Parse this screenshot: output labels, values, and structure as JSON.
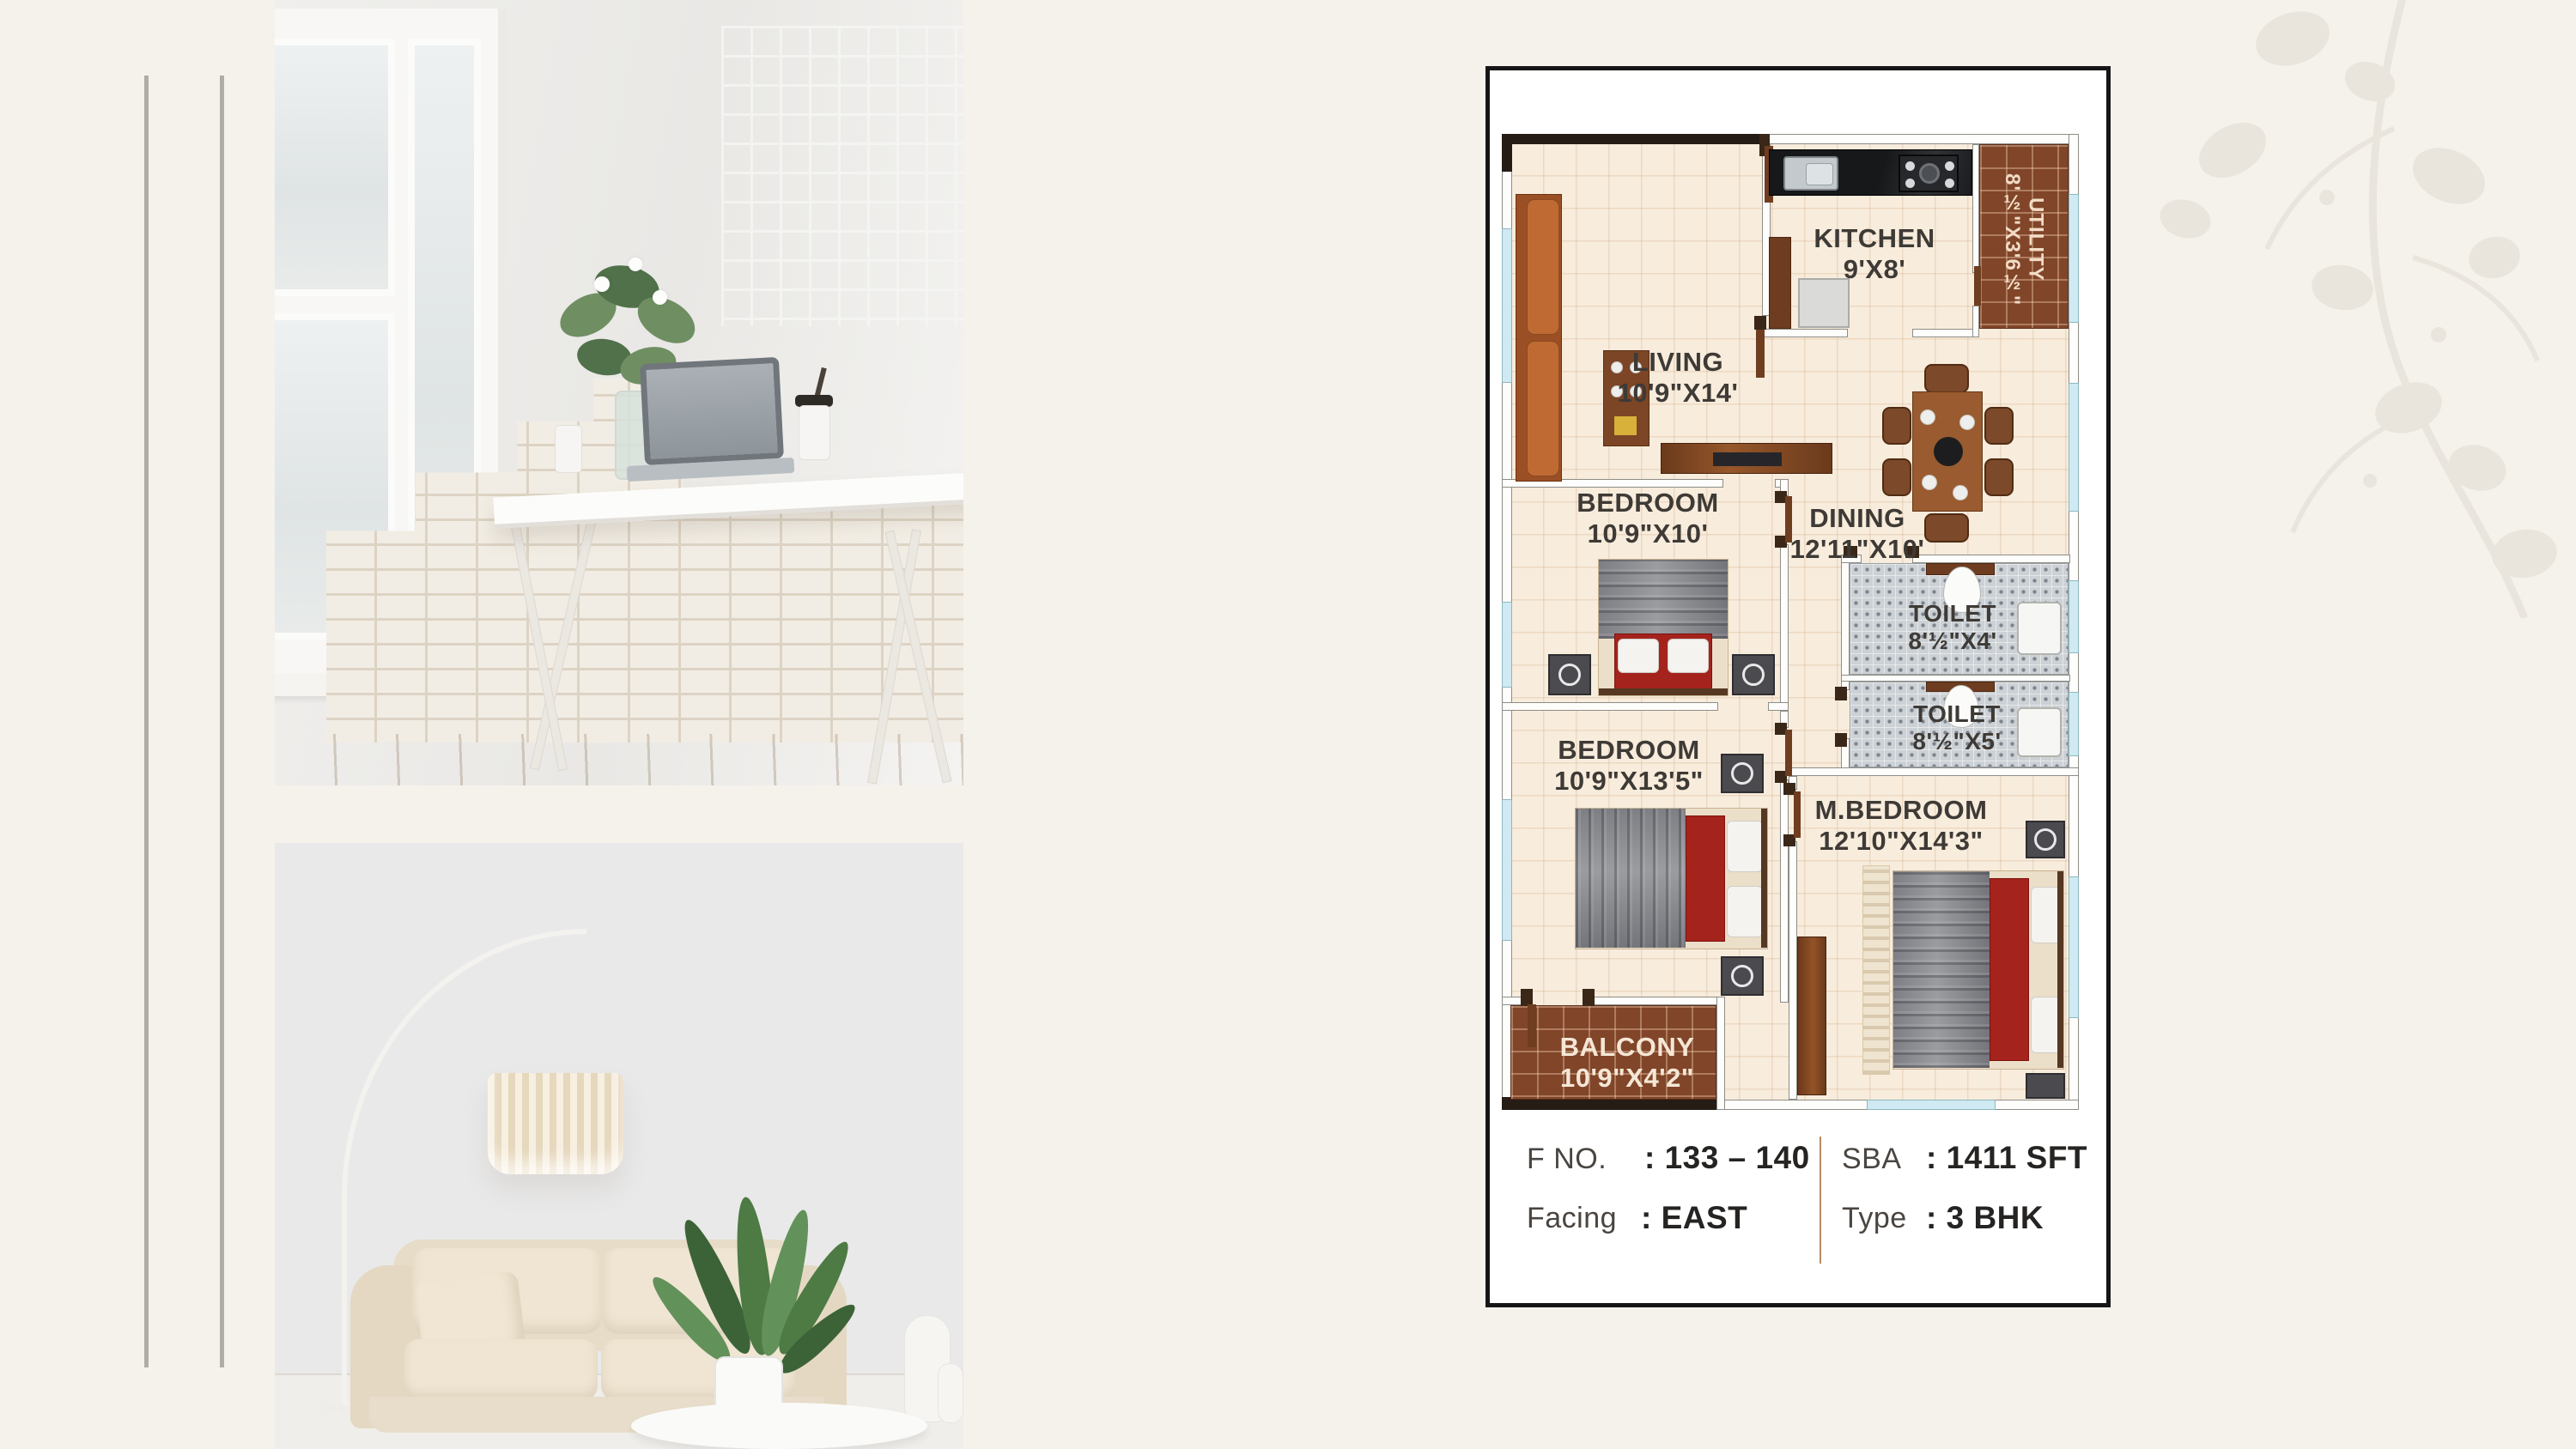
{
  "canvas": {
    "background": "#f5f2ec"
  },
  "photos": {
    "top_alt": "home office desk with laptop and flowers",
    "bottom_alt": "beige sofa with arc floor lamp and plant"
  },
  "floorplan": {
    "rooms": [
      {
        "id": "living",
        "name": "LIVING",
        "size": "10'9\"X14'"
      },
      {
        "id": "kitchen",
        "name": "KITCHEN",
        "size": "9'X8'"
      },
      {
        "id": "utility",
        "name": "UTILITY",
        "size": "8'½\"X3'6½\""
      },
      {
        "id": "bedroom-1",
        "name": "BEDROOM",
        "size": "10'9\"X10'"
      },
      {
        "id": "dining",
        "name": "DINING",
        "size": "12'11\"X10'"
      },
      {
        "id": "toilet-1",
        "name": "TOILET",
        "size": "8'½\"X4'"
      },
      {
        "id": "toilet-2",
        "name": "TOILET",
        "size": "8'½\"X5'"
      },
      {
        "id": "bedroom-2",
        "name": "BEDROOM",
        "size": "10'9\"X13'5\""
      },
      {
        "id": "m-bedroom",
        "name": "M.BEDROOM",
        "size": "12'10\"X14'3\""
      },
      {
        "id": "balcony",
        "name": "BALCONY",
        "size": "10'9\"X4'2\""
      }
    ],
    "info": {
      "fno_label": "F NO.",
      "fno_value": ": 133 – 140",
      "sba_label": "SBA",
      "sba_value": ": 1411 SFT",
      "facing_label": "Facing",
      "facing_value": ": EAST",
      "type_label": "Type",
      "type_value": ": 3 BHK"
    },
    "colors": {
      "card_border": "#161616",
      "floor_tile": "#f8ecdc",
      "wall_dark": "#241c15",
      "window_blue": "#cfeaf2",
      "balcony_tile": "#81452a",
      "toilet_mosaic": "#ccd1d5",
      "bed_red": "#a5231d",
      "sofa_orange": "#b4612e",
      "info_divider": "#b98a63",
      "label_text": "#3e3a36"
    }
  }
}
